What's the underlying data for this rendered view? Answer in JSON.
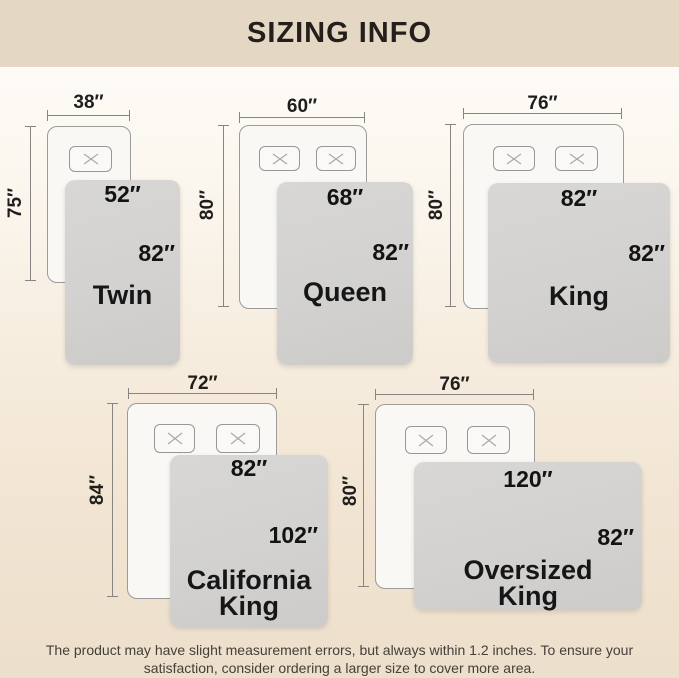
{
  "title": "SIZING INFO",
  "footer": {
    "line1": "The product may have slight measurement errors, but always within 1.2 inches. To ensure your",
    "line2": "satisfaction, consider ordering a larger size to cover more area."
  },
  "colors": {
    "header_bg": "#e4d8c4",
    "page_gradient_top": "#fffefd",
    "page_gradient_bottom": "#ecdfcb",
    "blanket": "#d2d1cf",
    "bed_fill": "#f9f8f5",
    "outline": "#9b9b9b",
    "dimension_line": "#878583",
    "text": "#1f1e1c"
  },
  "beds": [
    {
      "name": "Twin",
      "bed_width": "38″",
      "bed_length": "75″",
      "blanket_width": "52″",
      "blanket_length": "82″",
      "pillows": 1
    },
    {
      "name": "Queen",
      "bed_width": "60″",
      "bed_length": "80″",
      "blanket_width": "68″",
      "blanket_length": "82″",
      "pillows": 2
    },
    {
      "name": "King",
      "bed_width": "76″",
      "bed_length": "80″",
      "blanket_width": "82″",
      "blanket_length": "82″",
      "pillows": 2
    },
    {
      "name": "California King",
      "bed_width": "72″",
      "bed_length": "84″",
      "blanket_width": "82″",
      "blanket_length": "102″",
      "pillows": 2
    },
    {
      "name": "Oversized King",
      "bed_width": "76″",
      "bed_length": "80″",
      "blanket_width": "120″",
      "blanket_length": "82″",
      "pillows": 2
    }
  ]
}
